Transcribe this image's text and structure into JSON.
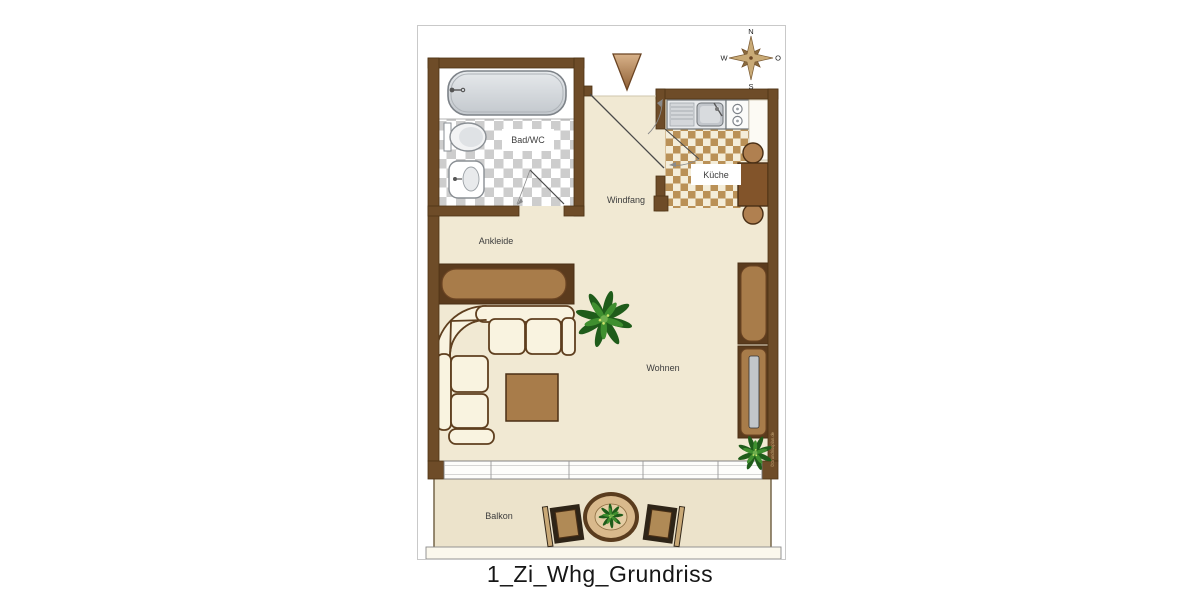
{
  "title": "1_Zi_Whg_Grundriss",
  "compass": {
    "north": "N",
    "east": "O",
    "south": "S",
    "west": "W"
  },
  "rooms": {
    "bathroom": "Bad/WC",
    "vestibule": "Windfang",
    "kitchen": "Küche",
    "dressing": "Ankleide",
    "living": "Wohnen",
    "balcony": "Balkon"
  },
  "watermark": "©Grundrissplan.de",
  "colors": {
    "wall": "#6e4c28",
    "wall_edge": "#4e3315",
    "floor": "#f1e9d3",
    "balcony_floor": "#ece3cb",
    "furniture_brown": "#a87c4a",
    "dark_brown": "#5f3f1f",
    "checker_gray": "#cdcdcd",
    "checker_tan": "#ba9157",
    "sofa_cream": "#f9f3e0",
    "tub_gray": "#d5d9dd",
    "plant_green": "#2e7a24"
  }
}
